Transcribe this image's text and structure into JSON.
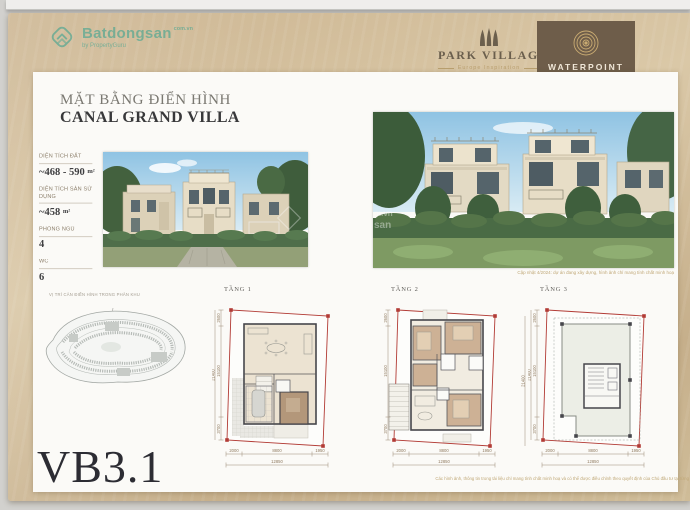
{
  "watermark": {
    "brand": "Batdongsan",
    "tld": "com.vn",
    "byline": "by PropertyGuru",
    "cropped_line1": "m.vn",
    "cropped_line2": "san"
  },
  "logos": {
    "park_village": {
      "name": "PARK VILLAGE",
      "tagline": "Europe Inspiration"
    },
    "waterpoint": {
      "name": "WATERPOINT",
      "tagline": "THÀNH PHỐ BÊN SÔNG"
    }
  },
  "header": {
    "title_line1": "MẶT BẰNG ĐIỂN HÌNH",
    "title_line2": "CANAL GRAND VILLA"
  },
  "stats": [
    {
      "label": "DIỆN TÍCH ĐẤT",
      "value": "~468 - 590",
      "unit": "m²"
    },
    {
      "label": "DIỆN TÍCH SÀN SỬ DỤNG",
      "value": "~458",
      "unit": "m²"
    },
    {
      "label": "PHÒNG NGỦ",
      "value": "4",
      "unit": ""
    },
    {
      "label": "WC",
      "value": "6",
      "unit": ""
    }
  ],
  "site_map": {
    "caption": "VỊ TRÍ CĂN ĐIỂN HÌNH TRONG PHÂN KHU"
  },
  "unit_code": "VB3.1",
  "floor_plans": {
    "labels": [
      "TẦNG 1",
      "TẦNG 2",
      "TẦNG 3"
    ]
  },
  "dims": {
    "bottom": [
      "2000",
      "8800",
      "1950"
    ],
    "bottom_total": "12850",
    "side": [
      "2600",
      "15100",
      "3700"
    ],
    "side_total": "21400"
  },
  "captions": {
    "render_note": "Cập nhật 4/2024: dự án đang xây dựng, hình ảnh chỉ mang tính chất minh hoạ",
    "disclaimer": "Các hình ảnh, thông tin trong tài liệu chỉ mang tính chất minh hoạ và có thể được điều chỉnh theo quyết định của Chủ đầu tư tại từng thời điểm. Quý khách vui lòng liên hệ Phòng Kinh doanh."
  },
  "colors": {
    "slide_tan": "#ccb591",
    "ribbon_brown": "#6e5d4a",
    "logo_gold": "#b99f6f",
    "watermark_teal": "#2fa08e",
    "lot_boundary_red": "#b23b35"
  }
}
